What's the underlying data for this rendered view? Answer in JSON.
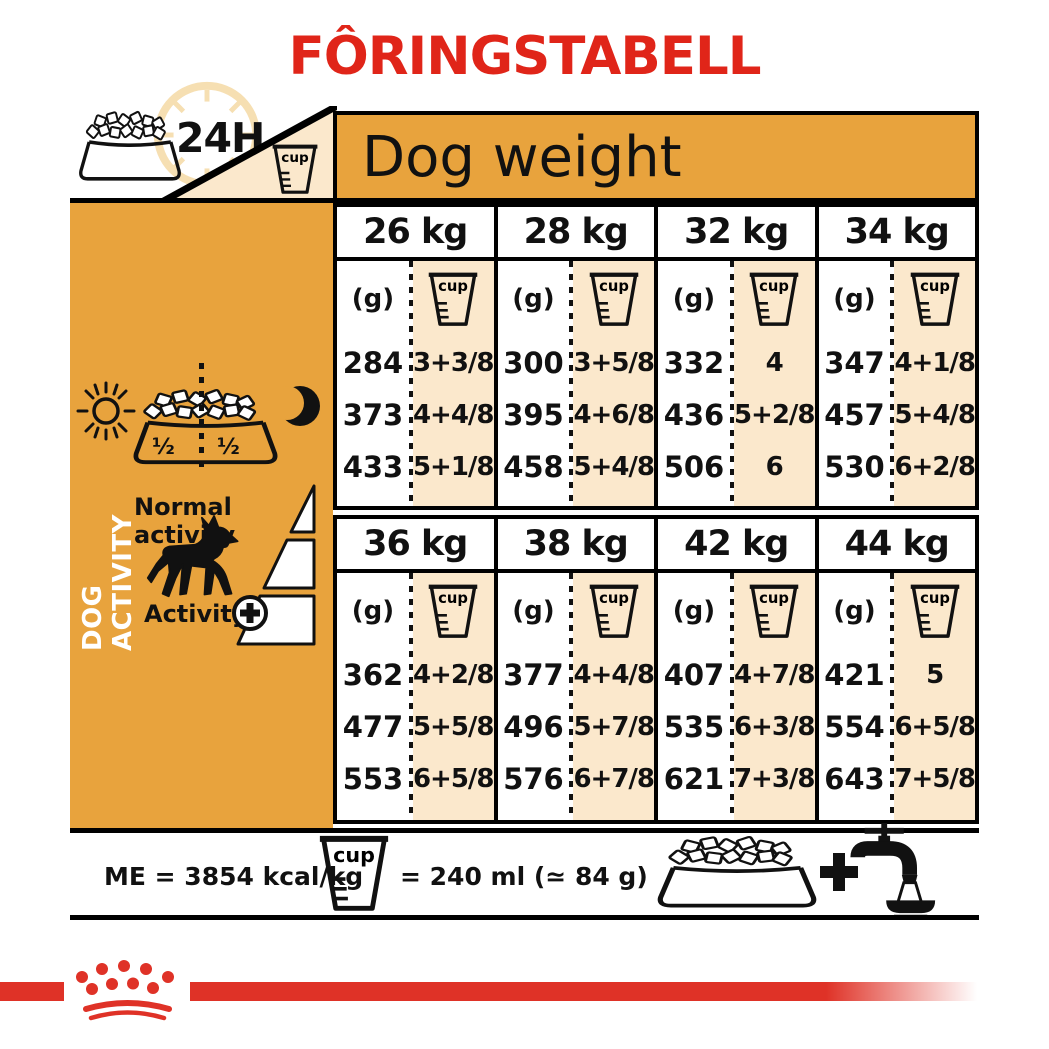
{
  "title": "FÔRINGSTABELL",
  "labels": {
    "h24": "24H",
    "cup": "cup",
    "dog_weight": "Dog weight",
    "grams_unit": "(g)"
  },
  "sidebar": {
    "dog_activity": "DOG ACTIVITY",
    "half_left": "½",
    "half_right": "½",
    "normal_activity": "Normal activity",
    "activity": "Activity"
  },
  "tables": [
    {
      "columns": [
        {
          "weight": "26 kg",
          "grams": [
            "284",
            "373",
            "433"
          ],
          "cups": [
            "3+3/8",
            "4+4/8",
            "5+1/8"
          ]
        },
        {
          "weight": "28 kg",
          "grams": [
            "300",
            "395",
            "458"
          ],
          "cups": [
            "3+5/8",
            "4+6/8",
            "5+4/8"
          ]
        },
        {
          "weight": "32 kg",
          "grams": [
            "332",
            "436",
            "506"
          ],
          "cups": [
            "4",
            "5+2/8",
            "6"
          ]
        },
        {
          "weight": "34 kg",
          "grams": [
            "347",
            "457",
            "530"
          ],
          "cups": [
            "4+1/8",
            "5+4/8",
            "6+2/8"
          ]
        }
      ]
    },
    {
      "columns": [
        {
          "weight": "36 kg",
          "grams": [
            "362",
            "477",
            "553"
          ],
          "cups": [
            "4+2/8",
            "5+5/8",
            "6+5/8"
          ]
        },
        {
          "weight": "38 kg",
          "grams": [
            "377",
            "496",
            "576"
          ],
          "cups": [
            "4+4/8",
            "5+7/8",
            "6+7/8"
          ]
        },
        {
          "weight": "42 kg",
          "grams": [
            "407",
            "535",
            "621"
          ],
          "cups": [
            "4+7/8",
            "6+3/8",
            "7+3/8"
          ]
        },
        {
          "weight": "44 kg",
          "grams": [
            "421",
            "554",
            "643"
          ],
          "cups": [
            "5",
            "6+5/8",
            "7+5/8"
          ]
        }
      ]
    }
  ],
  "footer": {
    "me_text": "ME = 3854 kcal/kg",
    "cup_equiv": "= 240 ml (≃ 84 g)"
  },
  "colors": {
    "orange": "#E8A33D",
    "cream": "#FBE8CC",
    "title_red": "#E02519",
    "brand_red": "#DF3227",
    "ink": "#111111"
  }
}
